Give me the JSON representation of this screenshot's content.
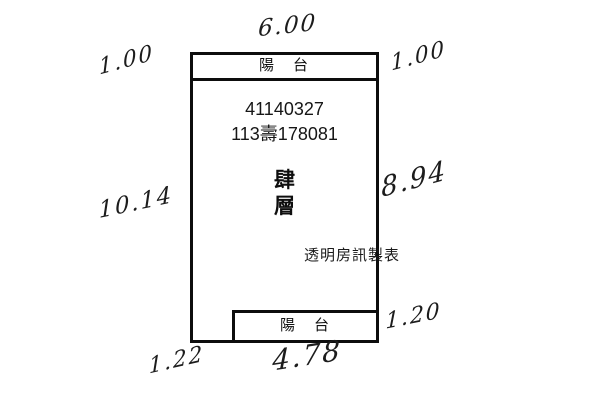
{
  "colors": {
    "ink": "#111111",
    "paper": "#ffffff"
  },
  "building": {
    "top_balcony_label": "陽　台",
    "bottom_balcony_label": "陽　台",
    "registration_number": "41140327",
    "case_number": "113壽178081",
    "floor_char_1": "肆",
    "floor_char_2": "層",
    "watermark": "透明房訊製表"
  },
  "handwritten_measurements": {
    "top_width": "6.00",
    "top_left_balcony_depth": "1.00",
    "top_right_balcony_depth": "1.00",
    "left_total_depth": "10.14",
    "right_main_depth": "8.94",
    "bottom_right_balcony_depth": "1.20",
    "bottom_left_offset": "1.22",
    "bottom_balcony_width": "4.78"
  }
}
